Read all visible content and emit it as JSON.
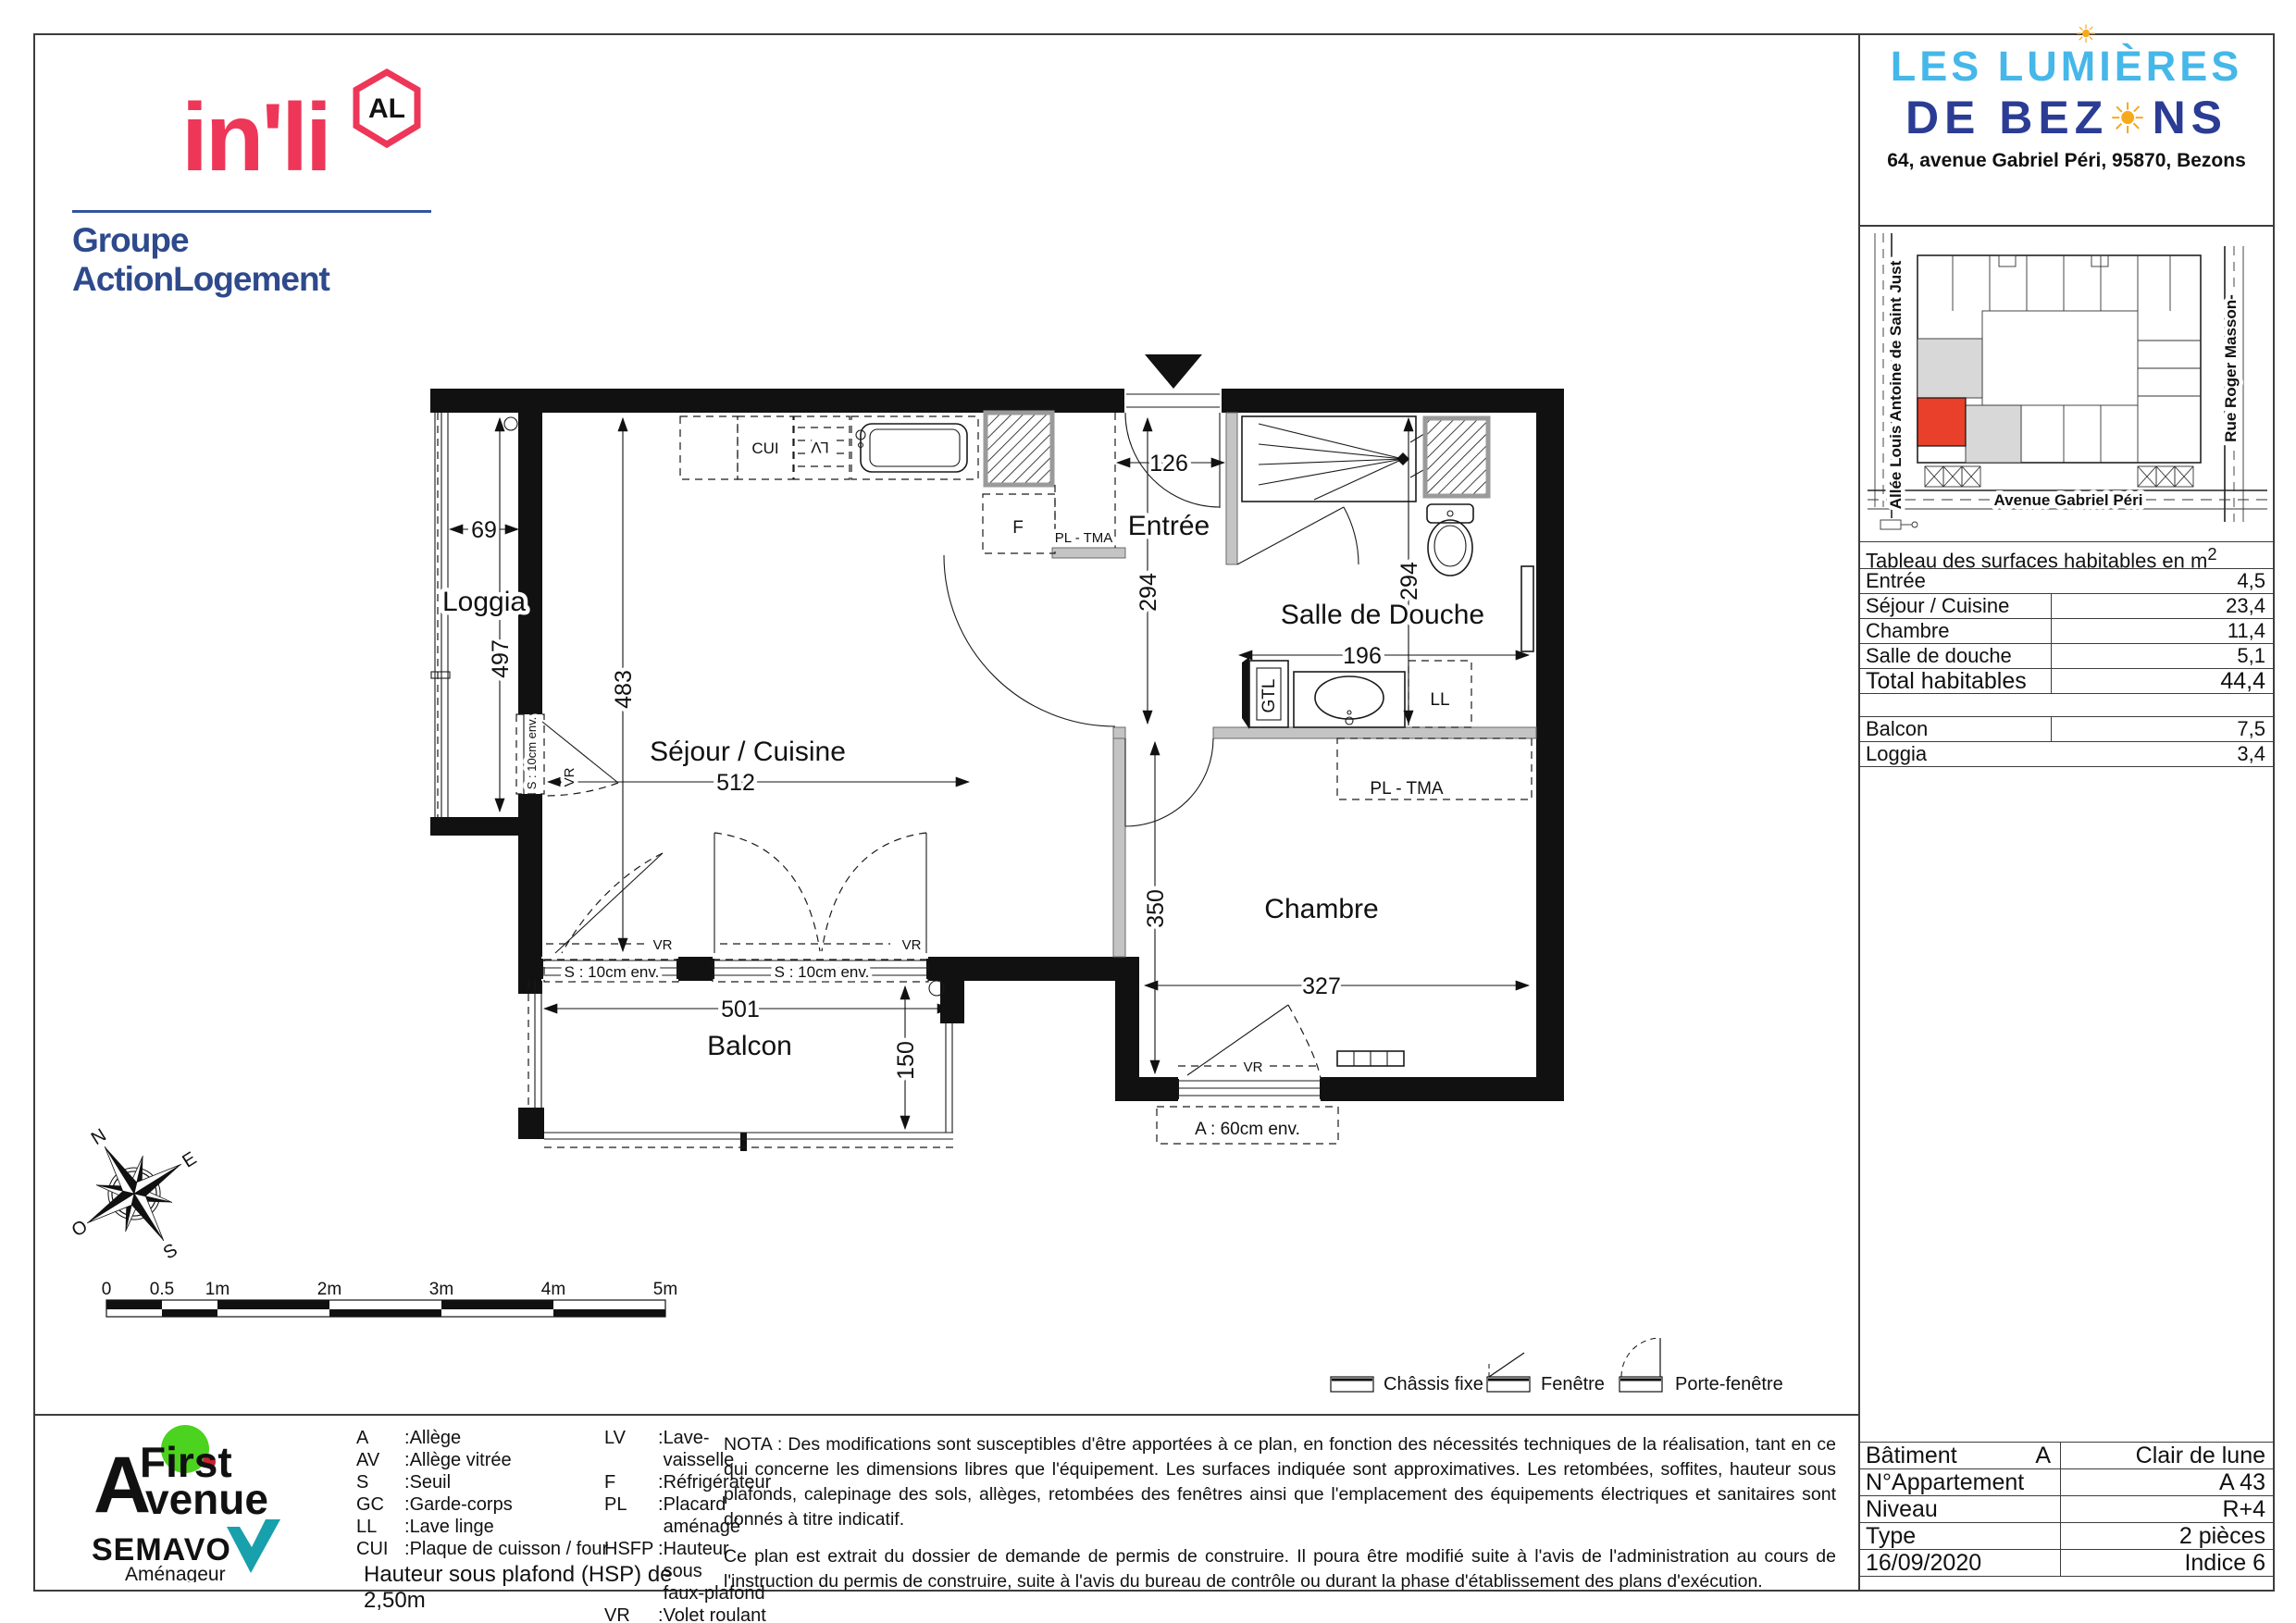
{
  "header": {
    "inli": {
      "wordmark": "in'li",
      "badge": "AL",
      "group": "Groupe ActionLogement"
    },
    "project": {
      "line1": "LES LUMIÈRES",
      "line2a": "DE BEZ",
      "line2b": "NS",
      "sun": "☀",
      "address": "64, avenue Gabriel Péri, 95870, Bezons"
    }
  },
  "site_map": {
    "street_left": "Allée Louis Antoine de Saint Just",
    "street_right": "Rue Roger Masson-",
    "street_bottom": "Avenue Gabriel Péri"
  },
  "surface_table": {
    "title": "Tableau des surfaces habitables en m",
    "title_sup": "2",
    "rows": [
      {
        "label": "Entrée",
        "value": "4,5"
      },
      {
        "label": "Séjour / Cuisine",
        "value": "23,4"
      },
      {
        "label": "Chambre",
        "value": "11,4"
      },
      {
        "label": "Salle de douche",
        "value": "5,1"
      },
      {
        "label": "Total habitables",
        "value": "44,4"
      },
      {
        "label": "Balcon",
        "value": "7,5"
      },
      {
        "label": "Loggia",
        "value": "3,4"
      }
    ]
  },
  "info_table": {
    "rows": [
      {
        "label": "Bâtiment",
        "label2": "A",
        "value": "Clair de lune"
      },
      {
        "label": "N°Appartement",
        "label2": "",
        "value": "A 43"
      },
      {
        "label": "Niveau",
        "label2": "",
        "value": "R+4"
      },
      {
        "label": "Type",
        "label2": "",
        "value": "2 pièces"
      },
      {
        "label": "16/09/2020",
        "label2": "",
        "value": "Indice 6"
      }
    ]
  },
  "plan": {
    "rooms": {
      "loggia": "Loggia",
      "sejour": "Séjour / Cuisine",
      "entree": "Entrée",
      "sdb": "Salle de Douche",
      "chambre": "Chambre",
      "balcon": "Balcon"
    },
    "dims": {
      "loggia_width": "69",
      "loggia_height": "497",
      "sejour_height": "483",
      "sejour_width": "512",
      "entree_width": "126",
      "entree_height": "294",
      "sdb_height": "294",
      "sdb_width": "196",
      "chambre_height": "350",
      "chambre_width": "327",
      "balcon_width": "501",
      "balcon_depth": "150"
    },
    "labels": {
      "cui": "CUI",
      "lv": "LV",
      "f": "F",
      "pl_tma": "PL - TMA",
      "gtl": "GTL",
      "ll": "LL",
      "vr": "VR",
      "seuil": "S : 10cm env.",
      "allege": "A : 60cm env."
    }
  },
  "window_legend": {
    "chassis": "Châssis fixe",
    "fenetre": "Fenêtre",
    "porte_fenetre": "Porte-fenêtre"
  },
  "abbreviations": {
    "col1": [
      {
        "a": "A",
        "d": "Allège"
      },
      {
        "a": "AV",
        "d": "Allège vitrée"
      },
      {
        "a": "S",
        "d": "Seuil"
      },
      {
        "a": "GC",
        "d": "Garde-corps"
      },
      {
        "a": "LL",
        "d": "Lave linge"
      },
      {
        "a": "CUI",
        "d": "Plaque de cuisson / four"
      }
    ],
    "col2": [
      {
        "a": "LV",
        "d": "Lave-vaisselle"
      },
      {
        "a": "F",
        "d": "Réfrigérateur"
      },
      {
        "a": "PL",
        "d": "Placard aménagé"
      },
      {
        "a": "HSFP",
        "d": "Hauteur sous\nfaux-plafond"
      },
      {
        "a": "VR",
        "d": "Volet roulant"
      }
    ],
    "ceiling": "Hauteur sous plafond (HSP) de 2,50m"
  },
  "nota": {
    "p1": "NOTA : Des modifications sont susceptibles d'être apportées à ce plan, en fonction des nécessités techniques de la réalisation, tant en ce qui concerne les dimensions libres que l'équipement. Les surfaces indiquée sont approximatives. Les retombées, soffites, hauteur sous plafonds, calepinage des sols, allèges, retombées des fenêtres ainsi que l'emplacement des équipements électriques et sanitaires sont donnés à titre indicatif.",
    "p2": "Ce plan est extrait du dossier de demande de permis de construire. Il poura être modifié suite à l'avis de l'administration au cours de l'instruction du permis de construire, suite à l'avis du bureau de contrôle ou durant la phase d'établissement des plans d'exécution."
  },
  "scale_bar": {
    "labels": [
      "0",
      "0.5",
      "1m",
      "2m",
      "3m",
      "4m",
      "5m"
    ]
  },
  "compass": {
    "n": "N",
    "e": "E",
    "s": "S",
    "o": "O"
  },
  "developers": {
    "fa_a": "A",
    "fa_first": "First",
    "fa_venue": "venue",
    "semavo": "SEMAVO",
    "semavo_sub": "Aménageur"
  }
}
